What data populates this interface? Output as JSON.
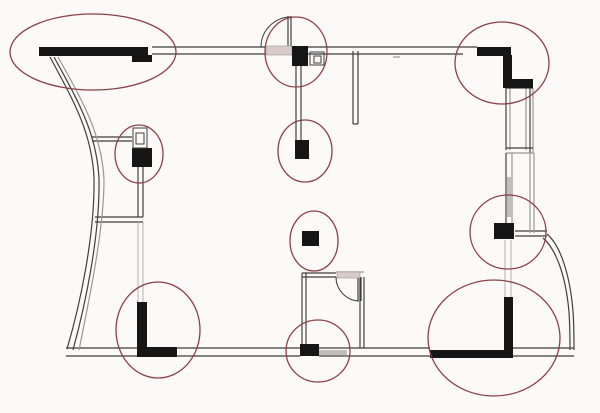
{
  "canvas": {
    "width": 600,
    "height": 413,
    "background": "#fbfaf8"
  },
  "colors": {
    "black": "#161616",
    "thin": "#3f3f3f",
    "light": "#9b9693",
    "faint": "#b7b0ac",
    "marker": "#8b4049",
    "hatch_fill": "#d9cbca",
    "gray_fill": "#c3bdb9"
  },
  "plan": {
    "thick_rects": [
      {
        "name": "top-left-wall-bar",
        "x": 39,
        "y": 47,
        "w": 109,
        "h": 9
      },
      {
        "name": "top-left-wall-step",
        "x": 132,
        "y": 55,
        "w": 20,
        "h": 7
      },
      {
        "name": "top-right-wall-bar",
        "x": 477,
        "y": 47,
        "w": 34,
        "h": 9
      },
      {
        "name": "top-right-wall-vertical",
        "x": 503,
        "y": 55,
        "w": 9,
        "h": 27
      },
      {
        "name": "top-right-wall-step",
        "x": 503,
        "y": 79,
        "w": 30,
        "h": 9
      },
      {
        "name": "column-top-middle",
        "x": 292,
        "y": 46,
        "w": 16,
        "h": 20
      },
      {
        "name": "column-mid-top",
        "x": 295,
        "y": 140,
        "w": 14,
        "h": 19
      },
      {
        "name": "column-mid-left",
        "x": 132,
        "y": 148,
        "w": 20,
        "h": 19
      },
      {
        "name": "column-center",
        "x": 302,
        "y": 231,
        "w": 17,
        "h": 15
      },
      {
        "name": "column-mid-right",
        "x": 494,
        "y": 223,
        "w": 20,
        "h": 16
      },
      {
        "name": "column-bottom-left-vert",
        "x": 137,
        "y": 302,
        "w": 10,
        "h": 55
      },
      {
        "name": "column-bottom-left-horiz",
        "x": 137,
        "y": 347,
        "w": 40,
        "h": 10
      },
      {
        "name": "column-bottom-middle",
        "x": 300,
        "y": 344,
        "w": 19,
        "h": 12
      },
      {
        "name": "column-bottom-right-vert",
        "x": 504,
        "y": 297,
        "w": 9,
        "h": 61
      },
      {
        "name": "column-bottom-right-horiz",
        "x": 430,
        "y": 350,
        "w": 83,
        "h": 8
      }
    ],
    "lines": [
      {
        "x1": 152,
        "y1": 47,
        "x2": 266,
        "y2": 47,
        "c": "thin"
      },
      {
        "x1": 308,
        "y1": 47,
        "x2": 477,
        "y2": 47,
        "c": "thin"
      },
      {
        "x1": 152,
        "y1": 54,
        "x2": 266,
        "y2": 54,
        "c": "thin"
      },
      {
        "x1": 308,
        "y1": 54,
        "x2": 463,
        "y2": 54,
        "c": "thin"
      },
      {
        "x1": 393,
        "y1": 57,
        "x2": 400,
        "y2": 57,
        "c": "light"
      },
      {
        "x1": 353,
        "y1": 51,
        "x2": 353,
        "y2": 124,
        "c": "thin"
      },
      {
        "x1": 358,
        "y1": 51,
        "x2": 358,
        "y2": 124,
        "c": "thin"
      },
      {
        "x1": 353,
        "y1": 124,
        "x2": 358,
        "y2": 124,
        "c": "thin"
      },
      {
        "x1": 296,
        "y1": 66,
        "x2": 296,
        "y2": 140,
        "c": "thin"
      },
      {
        "x1": 301,
        "y1": 66,
        "x2": 301,
        "y2": 140,
        "c": "thin"
      },
      {
        "x1": 288,
        "y1": 16,
        "x2": 288,
        "y2": 46,
        "c": "thin"
      },
      {
        "x1": 291,
        "y1": 16,
        "x2": 291,
        "y2": 46,
        "c": "thin"
      },
      {
        "x1": 92,
        "y1": 137,
        "x2": 132,
        "y2": 137,
        "c": "thin"
      },
      {
        "x1": 92,
        "y1": 141,
        "x2": 132,
        "y2": 141,
        "c": "thin"
      },
      {
        "x1": 138,
        "y1": 167,
        "x2": 138,
        "y2": 217,
        "c": "thin"
      },
      {
        "x1": 143,
        "y1": 167,
        "x2": 143,
        "y2": 217,
        "c": "thin"
      },
      {
        "x1": 95,
        "y1": 217,
        "x2": 143,
        "y2": 217,
        "c": "thin"
      },
      {
        "x1": 95,
        "y1": 222,
        "x2": 143,
        "y2": 222,
        "c": "thin"
      },
      {
        "x1": 138,
        "y1": 222,
        "x2": 138,
        "y2": 302,
        "c": "faint"
      },
      {
        "x1": 143,
        "y1": 222,
        "x2": 143,
        "y2": 302,
        "c": "faint"
      },
      {
        "x1": 302,
        "y1": 273,
        "x2": 302,
        "y2": 348,
        "c": "thin"
      },
      {
        "x1": 306,
        "y1": 273,
        "x2": 306,
        "y2": 348,
        "c": "thin"
      },
      {
        "x1": 360,
        "y1": 277,
        "x2": 360,
        "y2": 348,
        "c": "thin"
      },
      {
        "x1": 364,
        "y1": 277,
        "x2": 364,
        "y2": 348,
        "c": "thin"
      },
      {
        "x1": 302,
        "y1": 273,
        "x2": 336,
        "y2": 273,
        "c": "thin"
      },
      {
        "x1": 302,
        "y1": 277,
        "x2": 336,
        "y2": 277,
        "c": "thin"
      },
      {
        "x1": 336,
        "y1": 272,
        "x2": 364,
        "y2": 272,
        "c": "light"
      },
      {
        "x1": 358,
        "y1": 277,
        "x2": 358,
        "y2": 301,
        "c": "thin"
      },
      {
        "x1": 361,
        "y1": 277,
        "x2": 361,
        "y2": 301,
        "c": "thin"
      },
      {
        "x1": 66,
        "y1": 348,
        "x2": 137,
        "y2": 348,
        "c": "thin"
      },
      {
        "x1": 177,
        "y1": 348,
        "x2": 300,
        "y2": 348,
        "c": "thin"
      },
      {
        "x1": 319,
        "y1": 348,
        "x2": 430,
        "y2": 348,
        "c": "thin"
      },
      {
        "x1": 513,
        "y1": 348,
        "x2": 574,
        "y2": 348,
        "c": "thin"
      },
      {
        "x1": 66,
        "y1": 356,
        "x2": 137,
        "y2": 356,
        "c": "thin"
      },
      {
        "x1": 177,
        "y1": 356,
        "x2": 300,
        "y2": 356,
        "c": "thin"
      },
      {
        "x1": 319,
        "y1": 356,
        "x2": 430,
        "y2": 356,
        "c": "thin"
      },
      {
        "x1": 513,
        "y1": 356,
        "x2": 574,
        "y2": 356,
        "c": "thin"
      },
      {
        "x1": 515,
        "y1": 231,
        "x2": 547,
        "y2": 231,
        "c": "thin"
      },
      {
        "x1": 515,
        "y1": 236,
        "x2": 547,
        "y2": 236,
        "c": "thin"
      },
      {
        "x1": 505,
        "y1": 240,
        "x2": 505,
        "y2": 297,
        "c": "faint"
      },
      {
        "x1": 511,
        "y1": 240,
        "x2": 511,
        "y2": 297,
        "c": "faint"
      },
      {
        "x1": 506,
        "y1": 88,
        "x2": 506,
        "y2": 150,
        "c": "thin"
      },
      {
        "x1": 510,
        "y1": 88,
        "x2": 510,
        "y2": 150,
        "c": "light"
      },
      {
        "x1": 526,
        "y1": 88,
        "x2": 526,
        "y2": 150,
        "c": "light"
      },
      {
        "x1": 530,
        "y1": 88,
        "x2": 530,
        "y2": 153,
        "c": "thin"
      },
      {
        "x1": 533,
        "y1": 88,
        "x2": 533,
        "y2": 153,
        "c": "light"
      },
      {
        "x1": 506,
        "y1": 88,
        "x2": 533,
        "y2": 88,
        "c": "thin"
      },
      {
        "x1": 506,
        "y1": 148,
        "x2": 533,
        "y2": 148,
        "c": "thin"
      },
      {
        "x1": 506,
        "y1": 153,
        "x2": 534,
        "y2": 153,
        "c": "light"
      },
      {
        "x1": 506,
        "y1": 153,
        "x2": 506,
        "y2": 223,
        "c": "thin"
      },
      {
        "x1": 512,
        "y1": 153,
        "x2": 512,
        "y2": 223,
        "c": "light"
      },
      {
        "x1": 530,
        "y1": 153,
        "x2": 530,
        "y2": 233,
        "c": "light"
      },
      {
        "x1": 534,
        "y1": 153,
        "x2": 534,
        "y2": 233,
        "c": "light"
      }
    ],
    "curves": [
      {
        "name": "left-curved-wall-outer",
        "d": "M50,57 C72,98 92,132 94,178 C95,235 80,305 67,349",
        "c": "thin"
      },
      {
        "name": "left-curved-wall-mid",
        "d": "M54,57 C77,99 97,133 99,179 C100,236 85,306 73,350",
        "c": "thin"
      },
      {
        "name": "left-curved-wall-inner",
        "d": "M58,57 C82,100 102,134 104,180 C104,230 89,300 79,350",
        "c": "light"
      },
      {
        "name": "right-curved-wall-outer",
        "d": "M547,234 C561,246 570,276 573,311 C574,326 574,338 574,350",
        "c": "thin"
      },
      {
        "name": "right-curved-wall-inner",
        "d": "M543,238 C557,250 566,278 569,312 C570,327 570,339 570,350",
        "c": "thin"
      }
    ],
    "door_arcs": [
      {
        "name": "door-swing-top",
        "d": "M261,47 A30,30 0 0 1 291,17"
      },
      {
        "name": "door-swing-room",
        "d": "M336,277 A24,24 0 0 0 359,301"
      }
    ],
    "hatch_rects": [
      {
        "name": "door-opening-top",
        "x": 266,
        "y": 46,
        "w": 26,
        "h": 9
      },
      {
        "name": "door-opening-room",
        "x": 337,
        "y": 272,
        "w": 23,
        "h": 6
      }
    ],
    "gray_rects": [
      {
        "name": "wall-shade-bottom-middle",
        "x": 319,
        "y": 350,
        "w": 28,
        "h": 5
      },
      {
        "name": "window-shade-right-bay",
        "x": 507,
        "y": 177,
        "w": 5,
        "h": 40
      }
    ],
    "outlet_symbols": [
      {
        "name": "outlet-top-middle",
        "ox": 310,
        "oy": 52,
        "ow": 14,
        "oh": 13,
        "ix": 314,
        "iy": 56,
        "iw": 7,
        "ih": 7
      },
      {
        "name": "outlet-mid-left",
        "ox": 133,
        "oy": 128,
        "ow": 14,
        "oh": 20,
        "ix": 136,
        "iy": 133,
        "iw": 8,
        "ih": 11
      }
    ],
    "markers": [
      {
        "name": "marker-top-left-wall",
        "cx": 93,
        "cy": 52,
        "rx": 83,
        "ry": 38
      },
      {
        "name": "marker-top-middle-column",
        "cx": 296,
        "cy": 52,
        "rx": 31,
        "ry": 35
      },
      {
        "name": "marker-mid-top-column",
        "cx": 305,
        "cy": 151,
        "rx": 27,
        "ry": 31
      },
      {
        "name": "marker-mid-left-column",
        "cx": 139,
        "cy": 154,
        "rx": 24,
        "ry": 29
      },
      {
        "name": "marker-center-column",
        "cx": 314,
        "cy": 241,
        "rx": 24,
        "ry": 30
      },
      {
        "name": "marker-top-right-corner",
        "cx": 502,
        "cy": 63,
        "rx": 47,
        "ry": 41
      },
      {
        "name": "marker-mid-right-column",
        "cx": 508,
        "cy": 232,
        "rx": 38,
        "ry": 37
      },
      {
        "name": "marker-bottom-left-corner",
        "cx": 158,
        "cy": 330,
        "rx": 42,
        "ry": 48
      },
      {
        "name": "marker-bottom-middle-column",
        "cx": 318,
        "cy": 351,
        "rx": 32,
        "ry": 31
      },
      {
        "name": "marker-bottom-right-corner",
        "cx": 494,
        "cy": 338,
        "rx": 66,
        "ry": 58
      }
    ]
  }
}
